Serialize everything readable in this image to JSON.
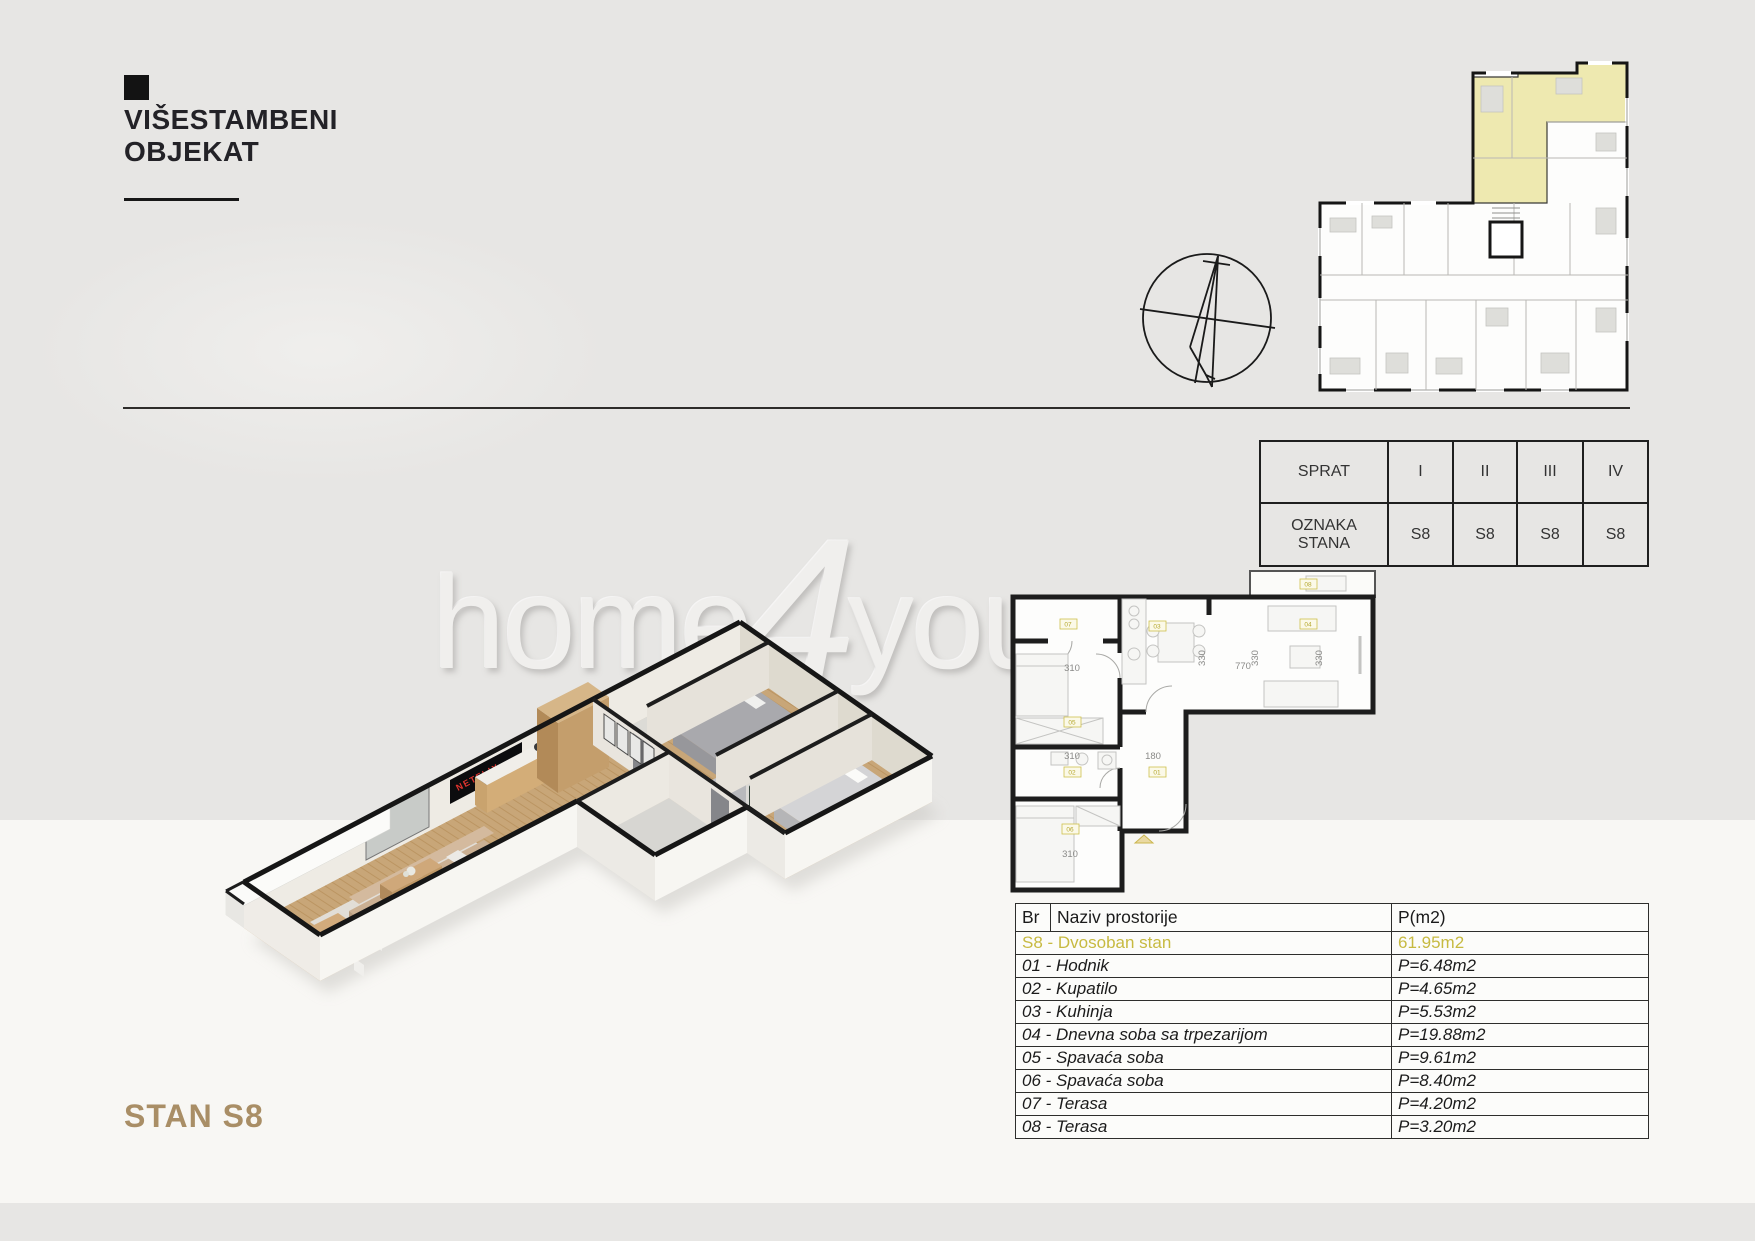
{
  "header": {
    "title_line1": "VIŠESTAMBENI",
    "title_line2": "OBJEKAT"
  },
  "floor_table": {
    "row1_label": "SPRAT",
    "row2_label": "OZNAKA STANA",
    "floors": [
      "I",
      "II",
      "III",
      "IV"
    ],
    "units": [
      "S8",
      "S8",
      "S8",
      "S8"
    ]
  },
  "watermark": {
    "home": "home",
    "four": "4",
    "you": "you",
    "me": "me"
  },
  "room_table": {
    "headers": {
      "br": "Br",
      "name": "Naziv prostorije",
      "area": "P(m2)"
    },
    "rows": [
      {
        "name": "S8 - Dvosoban stan",
        "area": "61.95m2"
      },
      {
        "name": "01 - Hodnik",
        "area": "P=6.48m2"
      },
      {
        "name": "02 - Kupatilo",
        "area": "P=4.65m2"
      },
      {
        "name": "03 - Kuhinja",
        "area": "P=5.53m2"
      },
      {
        "name": "04 - Dnevna soba sa trpezarijom",
        "area": "P=19.88m2"
      },
      {
        "name": "05 - Spavaća soba",
        "area": "P=9.61m2"
      },
      {
        "name": "06 - Spavaća soba",
        "area": "P=8.40m2"
      },
      {
        "name": "07 - Terasa",
        "area": "P=4.20m2"
      },
      {
        "name": "08 - Terasa",
        "area": "P=3.20m2"
      }
    ]
  },
  "plan2d": {
    "rooms": [
      "07",
      "05",
      "02",
      "06",
      "01",
      "03",
      "04",
      "08"
    ],
    "dims": [
      "310",
      "330",
      "770",
      "330",
      "330",
      "310",
      "180",
      "310"
    ]
  },
  "render3d": {
    "tv_text": "NETFLIX"
  },
  "footer": {
    "stan_label": "STAN S8"
  },
  "colors": {
    "page_bg": "#e7e6e4",
    "band_bg": "#f8f7f4",
    "accent_tan": "#a98e66",
    "highlight_yellow": "#c7ba41",
    "keyplan_yellow": "#eee9b0",
    "tv_brand_red": "#e0342e"
  }
}
